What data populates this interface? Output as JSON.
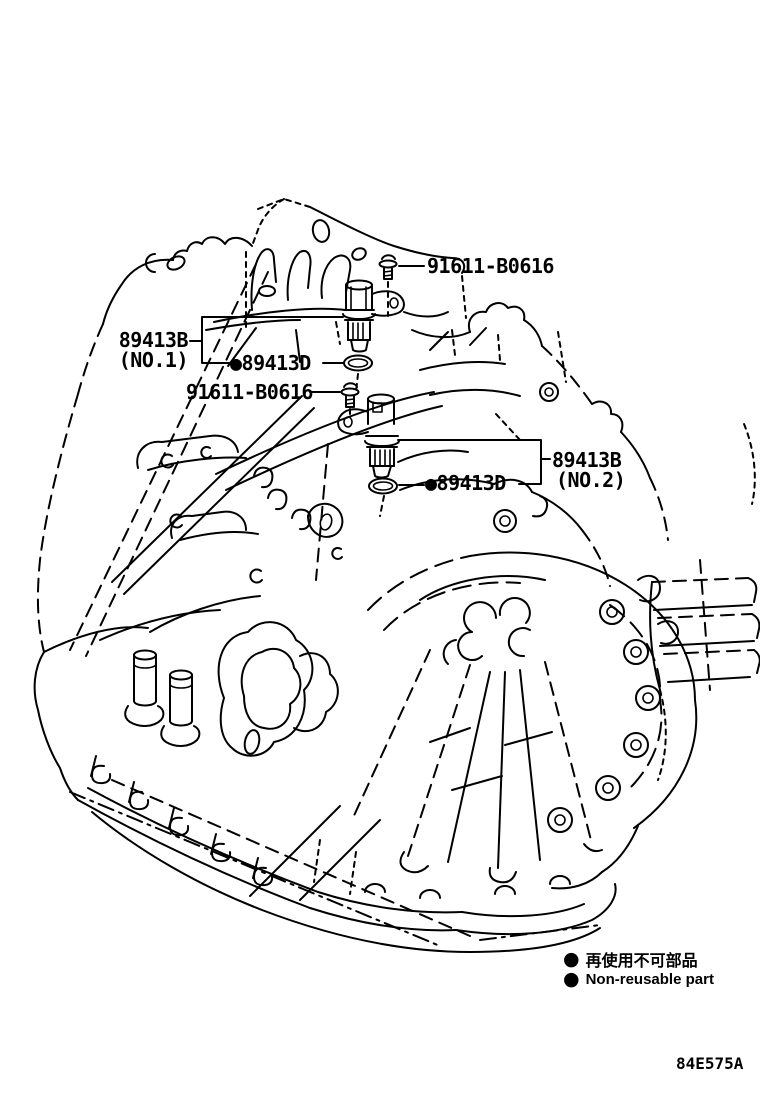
{
  "diagram": {
    "figure_code": "84E575A",
    "callouts": {
      "bolt_top": "91611-B0616",
      "bolt_mid": "91611-B0616",
      "sensor_no1": {
        "part": "89413B",
        "position": "(NO.1)"
      },
      "sensor_no2": {
        "part": "89413B",
        "position": "(NO.2)"
      },
      "oring_no1": {
        "label": "●89413D"
      },
      "oring_no2": {
        "label": "●89413D"
      }
    },
    "legend": {
      "bullet": "●",
      "line_ja": "再使用不可部品",
      "line_en": "Non-reusable part"
    },
    "colors": {
      "line": "#000000",
      "background": "#ffffff"
    }
  }
}
